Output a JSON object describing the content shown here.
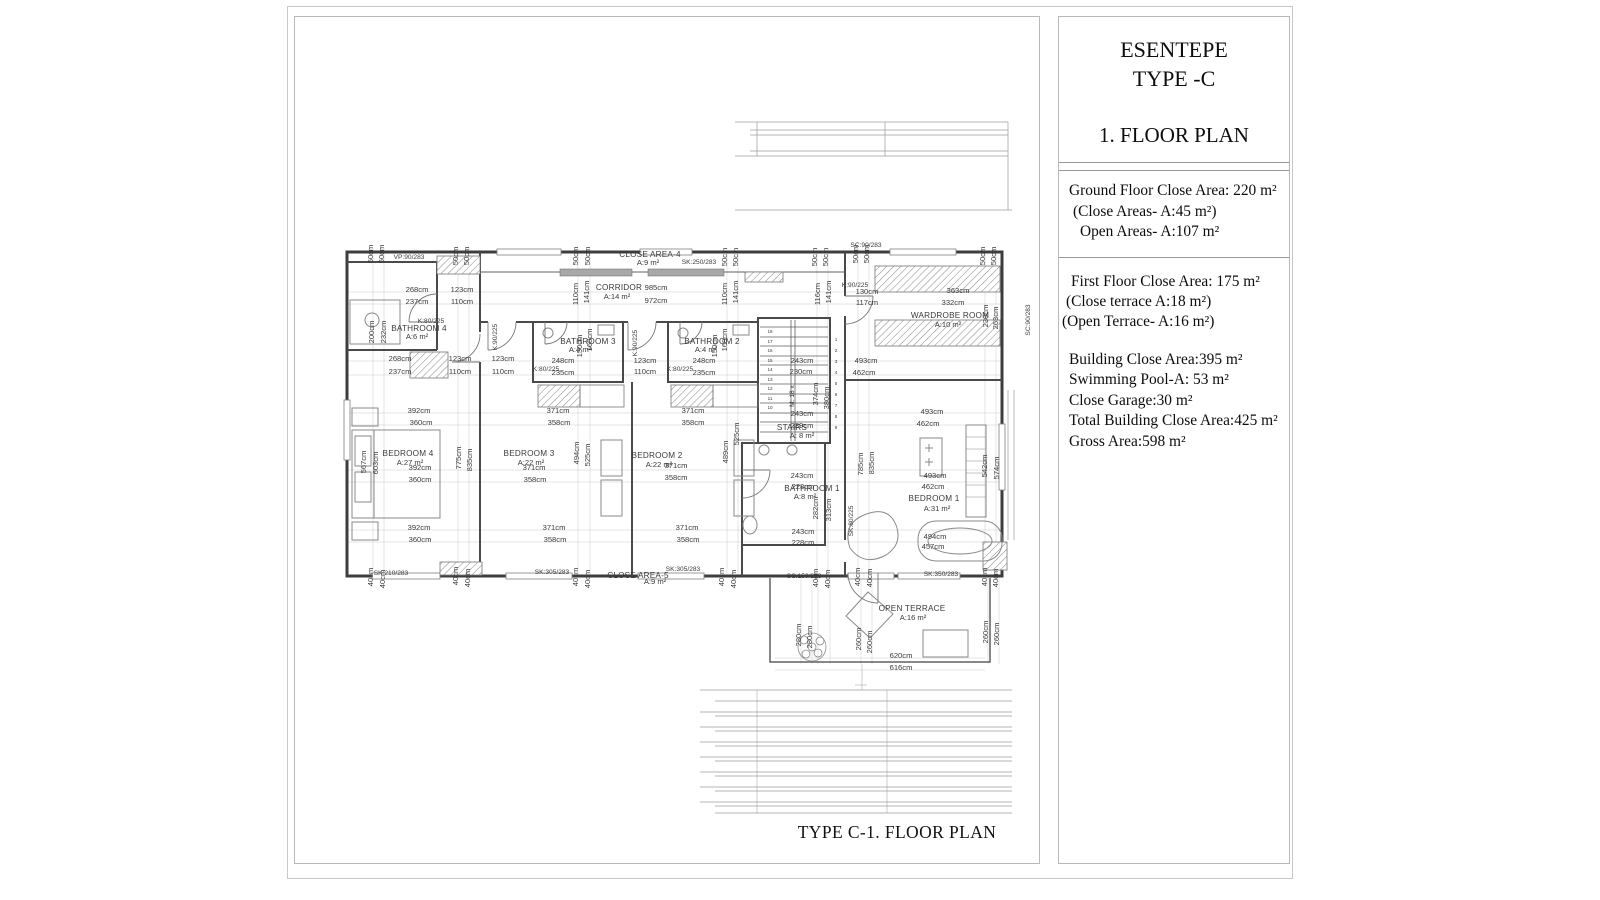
{
  "colors": {
    "wall": "#3d3d3d",
    "mid_line": "#555555",
    "thin_line": "#bdbdbd",
    "text": "#1c1c1c",
    "border": "#b8b8b8"
  },
  "sheet": {
    "caption": "TYPE C-1. FLOOR PLAN"
  },
  "panel": {
    "title1": "ESENTEPE",
    "title2": "TYPE -C",
    "subtitle": "1. FLOOR PLAN",
    "ground_floor": [
      "Ground Floor Close Area: 220 m²",
      "(Close Areas- A:45 m²)",
      "Open Areas- A:107 m²"
    ],
    "first_floor": [
      "First Floor Close Area: 175 m²",
      "(Close terrace A:18 m²)",
      "(Open Terrace- A:16 m²)"
    ],
    "totals": [
      "Building Close Area:395 m²",
      "Swimming Pool-A: 53 m²",
      "Close Garage:30 m²",
      "Total Building Close Area:425 m²",
      "Gross Area:598 m²"
    ]
  },
  "plan": {
    "labels": [
      {
        "t": "CLOSE AREA-4",
        "x": 650,
        "y": 257,
        "k": "room"
      },
      {
        "t": "A:9 m²",
        "x": 648,
        "y": 265,
        "k": "dim"
      },
      {
        "t": "SK:250/283",
        "x": 699,
        "y": 264,
        "k": "ref"
      },
      {
        "t": "CORRIDOR",
        "x": 619,
        "y": 290,
        "k": "room"
      },
      {
        "t": "A:14 m²",
        "x": 617,
        "y": 299,
        "k": "dim"
      },
      {
        "t": "BATHROOM 4",
        "x": 419,
        "y": 331,
        "k": "room"
      },
      {
        "t": "A:6 m²",
        "x": 417,
        "y": 339,
        "k": "dim"
      },
      {
        "t": "K:80/225",
        "x": 431,
        "y": 323,
        "k": "ref"
      },
      {
        "t": "BATHROOM 3",
        "x": 588,
        "y": 344,
        "k": "room"
      },
      {
        "t": "A:4 m²",
        "x": 580,
        "y": 352,
        "k": "dim"
      },
      {
        "t": "BATHROOM 2",
        "x": 712,
        "y": 344,
        "k": "room"
      },
      {
        "t": "A:4 m²",
        "x": 706,
        "y": 352,
        "k": "dim"
      },
      {
        "t": "WARDROBE ROOM",
        "x": 950,
        "y": 318,
        "k": "room"
      },
      {
        "t": "A:10 m²",
        "x": 948,
        "y": 327,
        "k": "dim"
      },
      {
        "t": "BEDROOM 4",
        "x": 408,
        "y": 456,
        "k": "room"
      },
      {
        "t": "A:27 m²",
        "x": 410,
        "y": 465,
        "k": "dim"
      },
      {
        "t": "BEDROOM 3",
        "x": 529,
        "y": 456,
        "k": "room"
      },
      {
        "t": "A:22 m²",
        "x": 531,
        "y": 465,
        "k": "dim"
      },
      {
        "t": "BEDROOM 2",
        "x": 657,
        "y": 458,
        "k": "room"
      },
      {
        "t": "A:22 m²",
        "x": 659,
        "y": 467,
        "k": "dim"
      },
      {
        "t": "BEDROOM 1",
        "x": 934,
        "y": 501,
        "k": "room"
      },
      {
        "t": "A:31 m²",
        "x": 937,
        "y": 511,
        "k": "dim"
      },
      {
        "t": "STAIRS",
        "x": 792,
        "y": 430,
        "k": "room"
      },
      {
        "t": "A: 8 m²",
        "x": 802,
        "y": 438,
        "k": "dim"
      },
      {
        "t": "BATHROOM 1",
        "x": 812,
        "y": 491,
        "k": "room"
      },
      {
        "t": "A:8 m²",
        "x": 805,
        "y": 499,
        "k": "dim"
      },
      {
        "t": "CLOSE AREA-5",
        "x": 638,
        "y": 578,
        "k": "room"
      },
      {
        "t": "A:9 m²",
        "x": 655,
        "y": 584,
        "k": "dim"
      },
      {
        "t": "OPEN TERRACE",
        "x": 912,
        "y": 611,
        "k": "room"
      },
      {
        "t": "A:16 m²",
        "x": 913,
        "y": 620,
        "k": "dim"
      },
      {
        "t": "VP:90/283",
        "x": 409,
        "y": 259,
        "k": "ref"
      },
      {
        "t": "SC:90/283",
        "x": 866,
        "y": 247,
        "k": "ref"
      },
      {
        "t": "K:90/225",
        "x": 855,
        "y": 287,
        "k": "ref"
      },
      {
        "t": "K:80/225",
        "x": 546,
        "y": 371,
        "k": "ref"
      },
      {
        "t": "K:80/225",
        "x": 680,
        "y": 371,
        "k": "ref"
      },
      {
        "t": "SK:210/283",
        "x": 391,
        "y": 575,
        "k": "ref"
      },
      {
        "t": "SK:305/283",
        "x": 552,
        "y": 574,
        "k": "ref"
      },
      {
        "t": "SK:305/283",
        "x": 683,
        "y": 571,
        "k": "ref"
      },
      {
        "t": "SC:150/283",
        "x": 804,
        "y": 578,
        "k": "ref"
      },
      {
        "t": "SK:350/283",
        "x": 941,
        "y": 576,
        "k": "ref"
      },
      {
        "t": "K:90/225",
        "x": 497,
        "y": 337,
        "r": -90,
        "k": "ref"
      },
      {
        "t": "K:90/225",
        "x": 637,
        "y": 343,
        "r": -90,
        "k": "ref"
      },
      {
        "t": "SK:80/225",
        "x": 853,
        "y": 521,
        "r": -90,
        "k": "ref"
      },
      {
        "t": "SC:90/283",
        "x": 1030,
        "y": 320,
        "r": -90,
        "k": "ref"
      },
      {
        "t": "M: 18 x",
        "x": 794,
        "y": 396,
        "r": -90,
        "k": "ref"
      },
      {
        "t": "268cm",
        "x": 417,
        "y": 292,
        "k": "dim"
      },
      {
        "t": "237cm",
        "x": 417,
        "y": 304,
        "k": "dim"
      },
      {
        "t": "123cm",
        "x": 462,
        "y": 292,
        "k": "dim"
      },
      {
        "t": "110cm",
        "x": 462,
        "y": 304,
        "k": "dim"
      },
      {
        "t": "985cm",
        "x": 656,
        "y": 290,
        "k": "dim"
      },
      {
        "t": "972cm",
        "x": 656,
        "y": 303,
        "k": "dim"
      },
      {
        "t": "130cm",
        "x": 867,
        "y": 294,
        "k": "dim"
      },
      {
        "t": "117cm",
        "x": 867,
        "y": 305,
        "k": "dim"
      },
      {
        "t": "363cm",
        "x": 958,
        "y": 293,
        "k": "dim"
      },
      {
        "t": "332cm",
        "x": 953,
        "y": 305,
        "k": "dim"
      },
      {
        "t": "50cm",
        "x": 373,
        "y": 254,
        "r": -90,
        "k": "dim"
      },
      {
        "t": "50cm",
        "x": 384,
        "y": 254,
        "r": -90,
        "k": "dim"
      },
      {
        "t": "50cm",
        "x": 458,
        "y": 256,
        "r": -90,
        "k": "dim"
      },
      {
        "t": "50cm",
        "x": 469,
        "y": 256,
        "r": -90,
        "k": "dim"
      },
      {
        "t": "50cm",
        "x": 578,
        "y": 256,
        "r": -90,
        "k": "dim"
      },
      {
        "t": "50cm",
        "x": 590,
        "y": 256,
        "r": -90,
        "k": "dim"
      },
      {
        "t": "50cm",
        "x": 727,
        "y": 257,
        "r": -90,
        "k": "dim"
      },
      {
        "t": "50cm",
        "x": 738,
        "y": 257,
        "r": -90,
        "k": "dim"
      },
      {
        "t": "50cm",
        "x": 817,
        "y": 257,
        "r": -90,
        "k": "dim"
      },
      {
        "t": "50cm",
        "x": 828,
        "y": 257,
        "r": -90,
        "k": "dim"
      },
      {
        "t": "50cm",
        "x": 858,
        "y": 254,
        "r": -90,
        "k": "dim"
      },
      {
        "t": "50cm",
        "x": 869,
        "y": 254,
        "r": -90,
        "k": "dim"
      },
      {
        "t": "50cm",
        "x": 985,
        "y": 256,
        "r": -90,
        "k": "dim"
      },
      {
        "t": "50cm",
        "x": 996,
        "y": 256,
        "r": -90,
        "k": "dim"
      },
      {
        "t": "110cm",
        "x": 578,
        "y": 294,
        "r": -90,
        "k": "dim"
      },
      {
        "t": "141cm",
        "x": 589,
        "y": 292,
        "r": -90,
        "k": "dim"
      },
      {
        "t": "110cm",
        "x": 727,
        "y": 294,
        "r": -90,
        "k": "dim"
      },
      {
        "t": "141cm",
        "x": 738,
        "y": 292,
        "r": -90,
        "k": "dim"
      },
      {
        "t": "116cm",
        "x": 820,
        "y": 294,
        "r": -90,
        "k": "dim"
      },
      {
        "t": "141cm",
        "x": 831,
        "y": 292,
        "r": -90,
        "k": "dim"
      },
      {
        "t": "200cm",
        "x": 374,
        "y": 332,
        "r": -90,
        "k": "dim"
      },
      {
        "t": "232cm",
        "x": 386,
        "y": 332,
        "r": -90,
        "k": "dim"
      },
      {
        "t": "150cm",
        "x": 582,
        "y": 346,
        "r": -90,
        "k": "dim"
      },
      {
        "t": "168cm",
        "x": 592,
        "y": 340,
        "r": -90,
        "k": "dim"
      },
      {
        "t": "150cm",
        "x": 717,
        "y": 346,
        "r": -90,
        "k": "dim"
      },
      {
        "t": "168cm",
        "x": 727,
        "y": 340,
        "r": -90,
        "k": "dim"
      },
      {
        "t": "268cm",
        "x": 400,
        "y": 361,
        "k": "dim"
      },
      {
        "t": "237cm",
        "x": 400,
        "y": 374,
        "k": "dim"
      },
      {
        "t": "123cm",
        "x": 460,
        "y": 361,
        "k": "dim"
      },
      {
        "t": "110cm",
        "x": 460,
        "y": 374,
        "k": "dim"
      },
      {
        "t": "123cm",
        "x": 503,
        "y": 361,
        "k": "dim"
      },
      {
        "t": "110cm",
        "x": 503,
        "y": 374,
        "k": "dim"
      },
      {
        "t": "248cm",
        "x": 563,
        "y": 363,
        "k": "dim"
      },
      {
        "t": "235cm",
        "x": 563,
        "y": 375,
        "k": "dim"
      },
      {
        "t": "123cm",
        "x": 645,
        "y": 363,
        "k": "dim"
      },
      {
        "t": "110cm",
        "x": 645,
        "y": 374,
        "k": "dim"
      },
      {
        "t": "248cm",
        "x": 704,
        "y": 363,
        "k": "dim"
      },
      {
        "t": "235cm",
        "x": 704,
        "y": 375,
        "k": "dim"
      },
      {
        "t": "243cm",
        "x": 802,
        "y": 363,
        "k": "dim"
      },
      {
        "t": "230cm",
        "x": 801,
        "y": 374,
        "k": "dim"
      },
      {
        "t": "493cm",
        "x": 866,
        "y": 363,
        "k": "dim"
      },
      {
        "t": "462cm",
        "x": 864,
        "y": 375,
        "k": "dim"
      },
      {
        "t": "567cm",
        "x": 366,
        "y": 462,
        "r": -90,
        "k": "dim"
      },
      {
        "t": "603cm",
        "x": 378,
        "y": 463,
        "r": -90,
        "k": "dim"
      },
      {
        "t": "775cm",
        "x": 461,
        "y": 458,
        "r": -90,
        "k": "dim"
      },
      {
        "t": "835cm",
        "x": 472,
        "y": 460,
        "r": -90,
        "k": "dim"
      },
      {
        "t": "494cm",
        "x": 579,
        "y": 453,
        "r": -90,
        "k": "dim"
      },
      {
        "t": "525cm",
        "x": 590,
        "y": 455,
        "r": -90,
        "k": "dim"
      },
      {
        "t": "489cm",
        "x": 728,
        "y": 452,
        "r": -90,
        "k": "dim"
      },
      {
        "t": "525cm",
        "x": 739,
        "y": 434,
        "r": -90,
        "k": "dim"
      },
      {
        "t": "785cm",
        "x": 863,
        "y": 464,
        "r": -90,
        "k": "dim"
      },
      {
        "t": "835cm",
        "x": 874,
        "y": 463,
        "r": -90,
        "k": "dim"
      },
      {
        "t": "542cm",
        "x": 987,
        "y": 466,
        "r": -90,
        "k": "dim"
      },
      {
        "t": "574cm",
        "x": 999,
        "y": 468,
        "r": -90,
        "k": "dim"
      },
      {
        "t": "230cm",
        "x": 988,
        "y": 316,
        "r": -90,
        "k": "dim"
      },
      {
        "t": "263cm",
        "x": 998,
        "y": 318,
        "r": -90,
        "k": "dim"
      },
      {
        "t": "374cm",
        "x": 818,
        "y": 394,
        "r": -90,
        "k": "dim"
      },
      {
        "t": "380cm",
        "x": 829,
        "y": 398,
        "r": -90,
        "k": "dim"
      },
      {
        "t": "282cm",
        "x": 818,
        "y": 508,
        "r": -90,
        "k": "dim"
      },
      {
        "t": "313cm",
        "x": 831,
        "y": 510,
        "r": -90,
        "k": "dim"
      },
      {
        "t": "392cm",
        "x": 419,
        "y": 413,
        "k": "dim"
      },
      {
        "t": "360cm",
        "x": 421,
        "y": 425,
        "k": "dim"
      },
      {
        "t": "371cm",
        "x": 558,
        "y": 413,
        "k": "dim"
      },
      {
        "t": "358cm",
        "x": 559,
        "y": 425,
        "k": "dim"
      },
      {
        "t": "371cm",
        "x": 693,
        "y": 413,
        "k": "dim"
      },
      {
        "t": "358cm",
        "x": 693,
        "y": 425,
        "k": "dim"
      },
      {
        "t": "493cm",
        "x": 932,
        "y": 414,
        "k": "dim"
      },
      {
        "t": "462cm",
        "x": 928,
        "y": 426,
        "k": "dim"
      },
      {
        "t": "392cm",
        "x": 420,
        "y": 470,
        "k": "dim"
      },
      {
        "t": "360cm",
        "x": 420,
        "y": 482,
        "k": "dim"
      },
      {
        "t": "371cm",
        "x": 534,
        "y": 470,
        "k": "dim"
      },
      {
        "t": "358cm",
        "x": 535,
        "y": 482,
        "k": "dim"
      },
      {
        "t": "371cm",
        "x": 676,
        "y": 468,
        "k": "dim"
      },
      {
        "t": "358cm",
        "x": 676,
        "y": 480,
        "k": "dim"
      },
      {
        "t": "243cm",
        "x": 802,
        "y": 416,
        "k": "dim"
      },
      {
        "t": "239cm",
        "x": 802,
        "y": 428,
        "k": "dim"
      },
      {
        "t": "243cm",
        "x": 802,
        "y": 478,
        "k": "dim"
      },
      {
        "t": "228cm",
        "x": 803,
        "y": 489,
        "k": "dim"
      },
      {
        "t": "493cm",
        "x": 935,
        "y": 478,
        "k": "dim"
      },
      {
        "t": "462cm",
        "x": 933,
        "y": 489,
        "k": "dim"
      },
      {
        "t": "392cm",
        "x": 419,
        "y": 530,
        "k": "dim"
      },
      {
        "t": "360cm",
        "x": 420,
        "y": 542,
        "k": "dim"
      },
      {
        "t": "371cm",
        "x": 554,
        "y": 530,
        "k": "dim"
      },
      {
        "t": "358cm",
        "x": 555,
        "y": 542,
        "k": "dim"
      },
      {
        "t": "371cm",
        "x": 687,
        "y": 530,
        "k": "dim"
      },
      {
        "t": "358cm",
        "x": 688,
        "y": 542,
        "k": "dim"
      },
      {
        "t": "243cm",
        "x": 803,
        "y": 534,
        "k": "dim"
      },
      {
        "t": "228cm",
        "x": 803,
        "y": 545,
        "k": "dim"
      },
      {
        "t": "494cm",
        "x": 935,
        "y": 539,
        "k": "dim"
      },
      {
        "t": "457cm",
        "x": 933,
        "y": 549,
        "k": "dim"
      },
      {
        "t": "40cm",
        "x": 373,
        "y": 577,
        "r": -90,
        "k": "dim"
      },
      {
        "t": "40cm",
        "x": 385,
        "y": 579,
        "r": -90,
        "k": "dim"
      },
      {
        "t": "40cm",
        "x": 458,
        "y": 576,
        "r": -90,
        "k": "dim"
      },
      {
        "t": "40cm",
        "x": 470,
        "y": 578,
        "r": -90,
        "k": "dim"
      },
      {
        "t": "40cm",
        "x": 578,
        "y": 577,
        "r": -90,
        "k": "dim"
      },
      {
        "t": "40cm",
        "x": 590,
        "y": 579,
        "r": -90,
        "k": "dim"
      },
      {
        "t": "40cm",
        "x": 724,
        "y": 577,
        "r": -90,
        "k": "dim"
      },
      {
        "t": "40cm",
        "x": 736,
        "y": 579,
        "r": -90,
        "k": "dim"
      },
      {
        "t": "40cm",
        "x": 818,
        "y": 578,
        "r": -90,
        "k": "dim"
      },
      {
        "t": "40cm",
        "x": 830,
        "y": 579,
        "r": -90,
        "k": "dim"
      },
      {
        "t": "40cm",
        "x": 860,
        "y": 577,
        "r": -90,
        "k": "dim"
      },
      {
        "t": "40cm",
        "x": 872,
        "y": 578,
        "r": -90,
        "k": "dim"
      },
      {
        "t": "40cm",
        "x": 987,
        "y": 577,
        "r": -90,
        "k": "dim"
      },
      {
        "t": "40cm",
        "x": 998,
        "y": 578,
        "r": -90,
        "k": "dim"
      },
      {
        "t": "620cm",
        "x": 901,
        "y": 658,
        "k": "dim"
      },
      {
        "t": "616cm",
        "x": 901,
        "y": 670,
        "k": "dim"
      },
      {
        "t": "280cm",
        "x": 801,
        "y": 635,
        "r": -90,
        "k": "dim"
      },
      {
        "t": "280cm",
        "x": 812,
        "y": 637,
        "r": -90,
        "k": "dim"
      },
      {
        "t": "260cm",
        "x": 861,
        "y": 639,
        "r": -90,
        "k": "dim"
      },
      {
        "t": "260cm",
        "x": 872,
        "y": 642,
        "r": -90,
        "k": "dim"
      },
      {
        "t": "260cm",
        "x": 988,
        "y": 632,
        "r": -90,
        "k": "dim"
      },
      {
        "t": "260cm",
        "x": 999,
        "y": 634,
        "r": -90,
        "k": "dim"
      },
      {
        "t": "18",
        "x": 770,
        "y": 333,
        "k": "num"
      },
      {
        "t": "17",
        "x": 770,
        "y": 343,
        "k": "num"
      },
      {
        "t": "16",
        "x": 770,
        "y": 352,
        "k": "num"
      },
      {
        "t": "15",
        "x": 770,
        "y": 362,
        "k": "num"
      },
      {
        "t": "14",
        "x": 770,
        "y": 371,
        "k": "num"
      },
      {
        "t": "13",
        "x": 770,
        "y": 381,
        "k": "num"
      },
      {
        "t": "12",
        "x": 770,
        "y": 390,
        "k": "num"
      },
      {
        "t": "11",
        "x": 770,
        "y": 400,
        "k": "num"
      },
      {
        "t": "10",
        "x": 770,
        "y": 409,
        "k": "num"
      },
      {
        "t": "1",
        "x": 836,
        "y": 341,
        "k": "num"
      },
      {
        "t": "2",
        "x": 836,
        "y": 352,
        "k": "num"
      },
      {
        "t": "3",
        "x": 836,
        "y": 363,
        "k": "num"
      },
      {
        "t": "4",
        "x": 836,
        "y": 374,
        "k": "num"
      },
      {
        "t": "5",
        "x": 836,
        "y": 385,
        "k": "num"
      },
      {
        "t": "6",
        "x": 836,
        "y": 396,
        "k": "num"
      },
      {
        "t": "7",
        "x": 836,
        "y": 407,
        "k": "num"
      },
      {
        "t": "8",
        "x": 836,
        "y": 418,
        "k": "num"
      },
      {
        "t": "9",
        "x": 836,
        "y": 429,
        "k": "num"
      }
    ]
  }
}
